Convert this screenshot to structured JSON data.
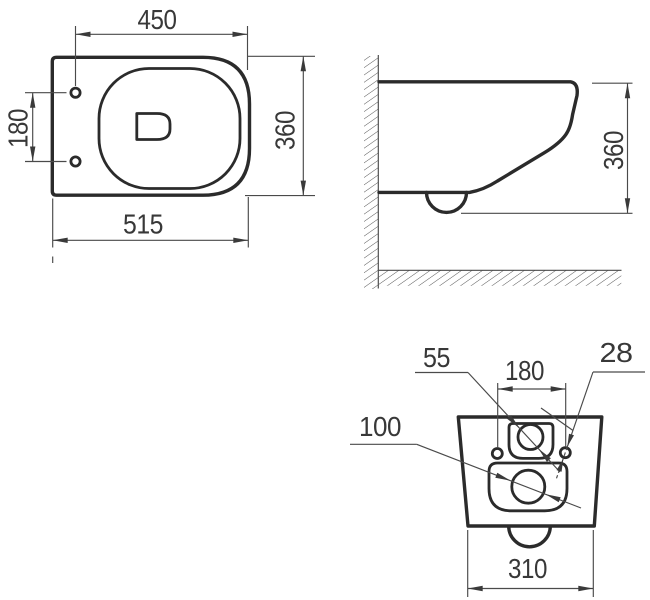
{
  "drawing": {
    "title": "Wall-hung toilet dimensional drawing, three orthographic views",
    "colors": {
      "outline": "#2b2b2b",
      "dimension_line": "#4a4a4a",
      "label_text": "#383838",
      "background": "#ffffff"
    },
    "top_view": {
      "width_450": "450",
      "hole_spacing_180": "180",
      "depth_360": "360",
      "length_515": "515"
    },
    "side_view": {
      "height_360": "360"
    },
    "rear_view": {
      "inlet_55": "55",
      "hole_spacing_180": "180",
      "hole_28": "28",
      "outlet_100": "100",
      "width_310": "310"
    }
  }
}
